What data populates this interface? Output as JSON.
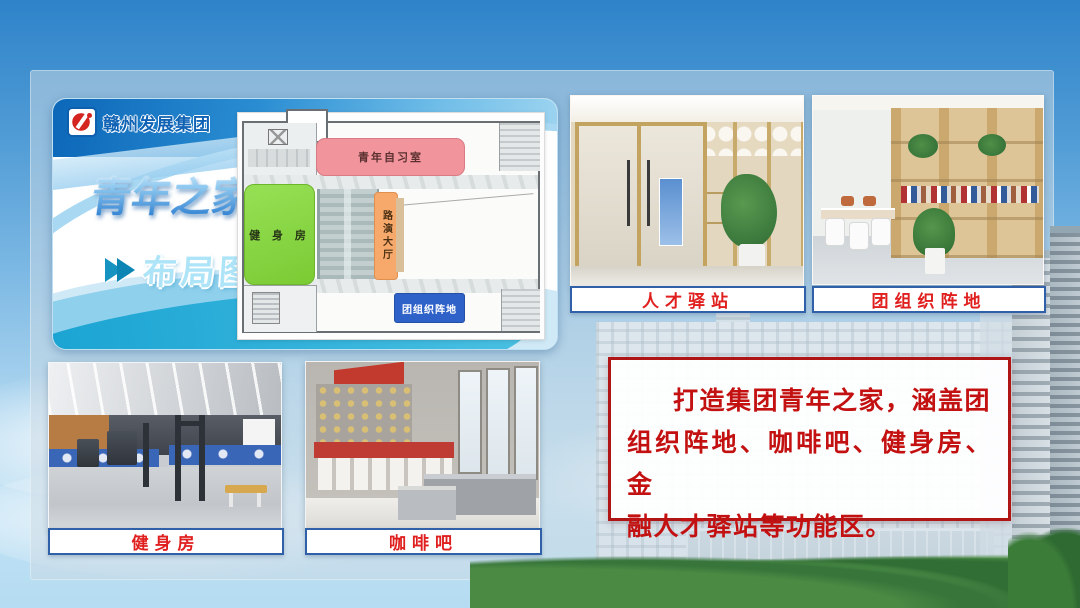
{
  "slide": {
    "brand": {
      "logo_text": "赣州发展集团",
      "logo_icon": "company-logo-icon"
    },
    "title": "青年之家",
    "section": {
      "arrow_icon": "double-chevron-icon",
      "label": "布局图"
    },
    "floor_plan": {
      "rooms": {
        "study": {
          "label": "青年自习室",
          "color": "#F2949C"
        },
        "gym": {
          "label": "健 身 房",
          "color": "#84D73C"
        },
        "roadshow": {
          "label": "路演大厅",
          "color": "#F6A96B"
        },
        "league": {
          "label": "团组织阵地",
          "color": "#2F62C8"
        }
      }
    },
    "photos": {
      "talent": {
        "caption": "人才驿站"
      },
      "league": {
        "caption": "团组织阵地"
      },
      "gym": {
        "caption": "健身房"
      },
      "coffee": {
        "caption": "咖啡吧"
      }
    },
    "description": {
      "full_text": "打造集团青年之家，涵盖团组织阵地、咖啡吧、健身房、金融人才驿站等功能区。",
      "lines": [
        "打造集团青年之家，涵盖团",
        "组织阵地、咖啡吧、健身房、金",
        "融人才驿站等功能区。"
      ]
    },
    "colors": {
      "brand_blue": "#0F62B4",
      "subtitle_cyan": "#AEE4F8",
      "caption_text": "#E01F1F",
      "caption_border": "#3060A8",
      "description_text": "#C31111",
      "description_border": "#B01515"
    }
  }
}
